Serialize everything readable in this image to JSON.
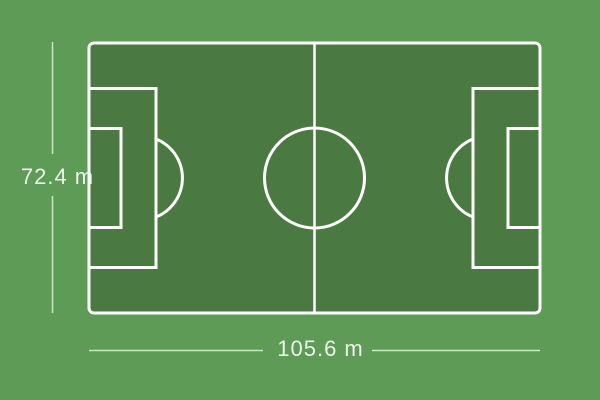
{
  "diagram": {
    "subject": "soccer-field-dimensions",
    "height_label": "72.4 m",
    "width_label": "105.6 m"
  },
  "colors": {
    "background": "#5d9b57",
    "field": "#4a7941",
    "line": "#ffffff",
    "dimension": "#edf3ec"
  }
}
